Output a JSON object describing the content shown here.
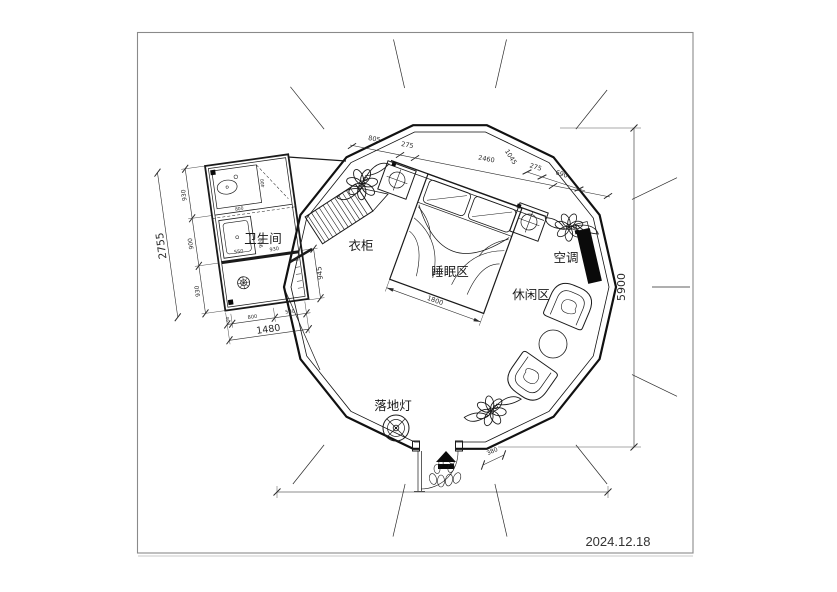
{
  "meta": {
    "date": "2024.12.18"
  },
  "labels": {
    "bathroom": "卫生间",
    "wardrobe": "衣柜",
    "sleeping_area": "睡眠区",
    "leisure_area": "休闲区",
    "air_conditioner": "空调",
    "floor_lamp": "落地灯"
  },
  "dimensions": {
    "top_chain": [
      "805",
      "275",
      "2460",
      "1045"
    ],
    "right_chain": [
      "275",
      "690"
    ],
    "bed_width": "1800",
    "overall_height": "5900",
    "entrance_step": "380",
    "bathroom": {
      "left_total": "2755",
      "left_segments": [
        "930",
        "900",
        "930"
      ],
      "bottom_total": "1480",
      "bottom_segments": [
        "90",
        "800",
        "580"
      ],
      "right_side": "945",
      "shower_width": "550",
      "inner_width": "930",
      "inner_depth": "900",
      "vanity_width": "800",
      "vanity_depth": "400"
    }
  },
  "colors": {
    "line": "#1a1a1a",
    "dim_text": "#2a2a2a",
    "black_fill": "#0a0a0a",
    "frame": "#8a8a8a"
  }
}
